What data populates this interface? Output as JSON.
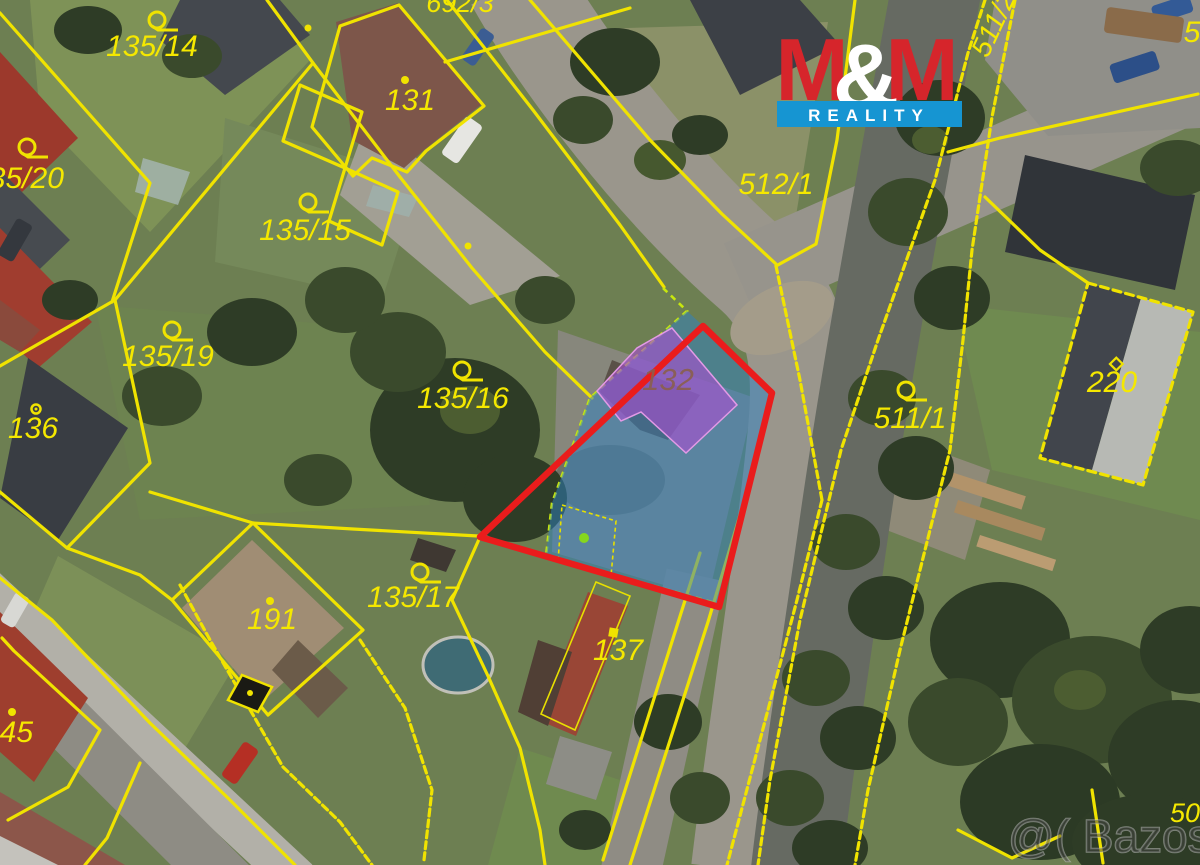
{
  "labels": [
    {
      "id": "parcel-135-14",
      "text": "135/14"
    },
    {
      "id": "parcel-131",
      "text": "131"
    },
    {
      "id": "parcel-692-3",
      "text": "692/3"
    },
    {
      "id": "parcel-135-20",
      "text": "135/20"
    },
    {
      "id": "parcel-135-15",
      "text": "135/15"
    },
    {
      "id": "parcel-512-1",
      "text": "512/1"
    },
    {
      "id": "parcel-511-2",
      "text": "511/2"
    },
    {
      "id": "parcel-5-partial",
      "text": "5"
    },
    {
      "id": "parcel-135-19",
      "text": "135/19"
    },
    {
      "id": "parcel-136",
      "text": "136"
    },
    {
      "id": "parcel-135-16",
      "text": "135/16"
    },
    {
      "id": "parcel-132",
      "text": "132"
    },
    {
      "id": "parcel-511-1",
      "text": "511/1"
    },
    {
      "id": "parcel-220",
      "text": "220"
    },
    {
      "id": "parcel-135-17",
      "text": "135/17"
    },
    {
      "id": "parcel-191",
      "text": "191"
    },
    {
      "id": "parcel-137",
      "text": "137"
    },
    {
      "id": "parcel-145",
      "text": "145"
    },
    {
      "id": "parcel-50-partial",
      "text": "50"
    }
  ],
  "logo": {
    "m_left": "M",
    "ampersand": "&",
    "m_right": "M",
    "banner": "REALITY"
  },
  "watermark": {
    "text": "@( Bazos.cz"
  },
  "highlight": {
    "parcel_outline_color": "#ea1c1c",
    "parcel_fill_color": "#2e81c4",
    "building_fill_color": "#a94fd0",
    "boundary_dash_color": "#c7e60e",
    "point_color": "#86d61e"
  },
  "map": {
    "line_color": "#f0e300",
    "label_color": "#f5e800"
  }
}
